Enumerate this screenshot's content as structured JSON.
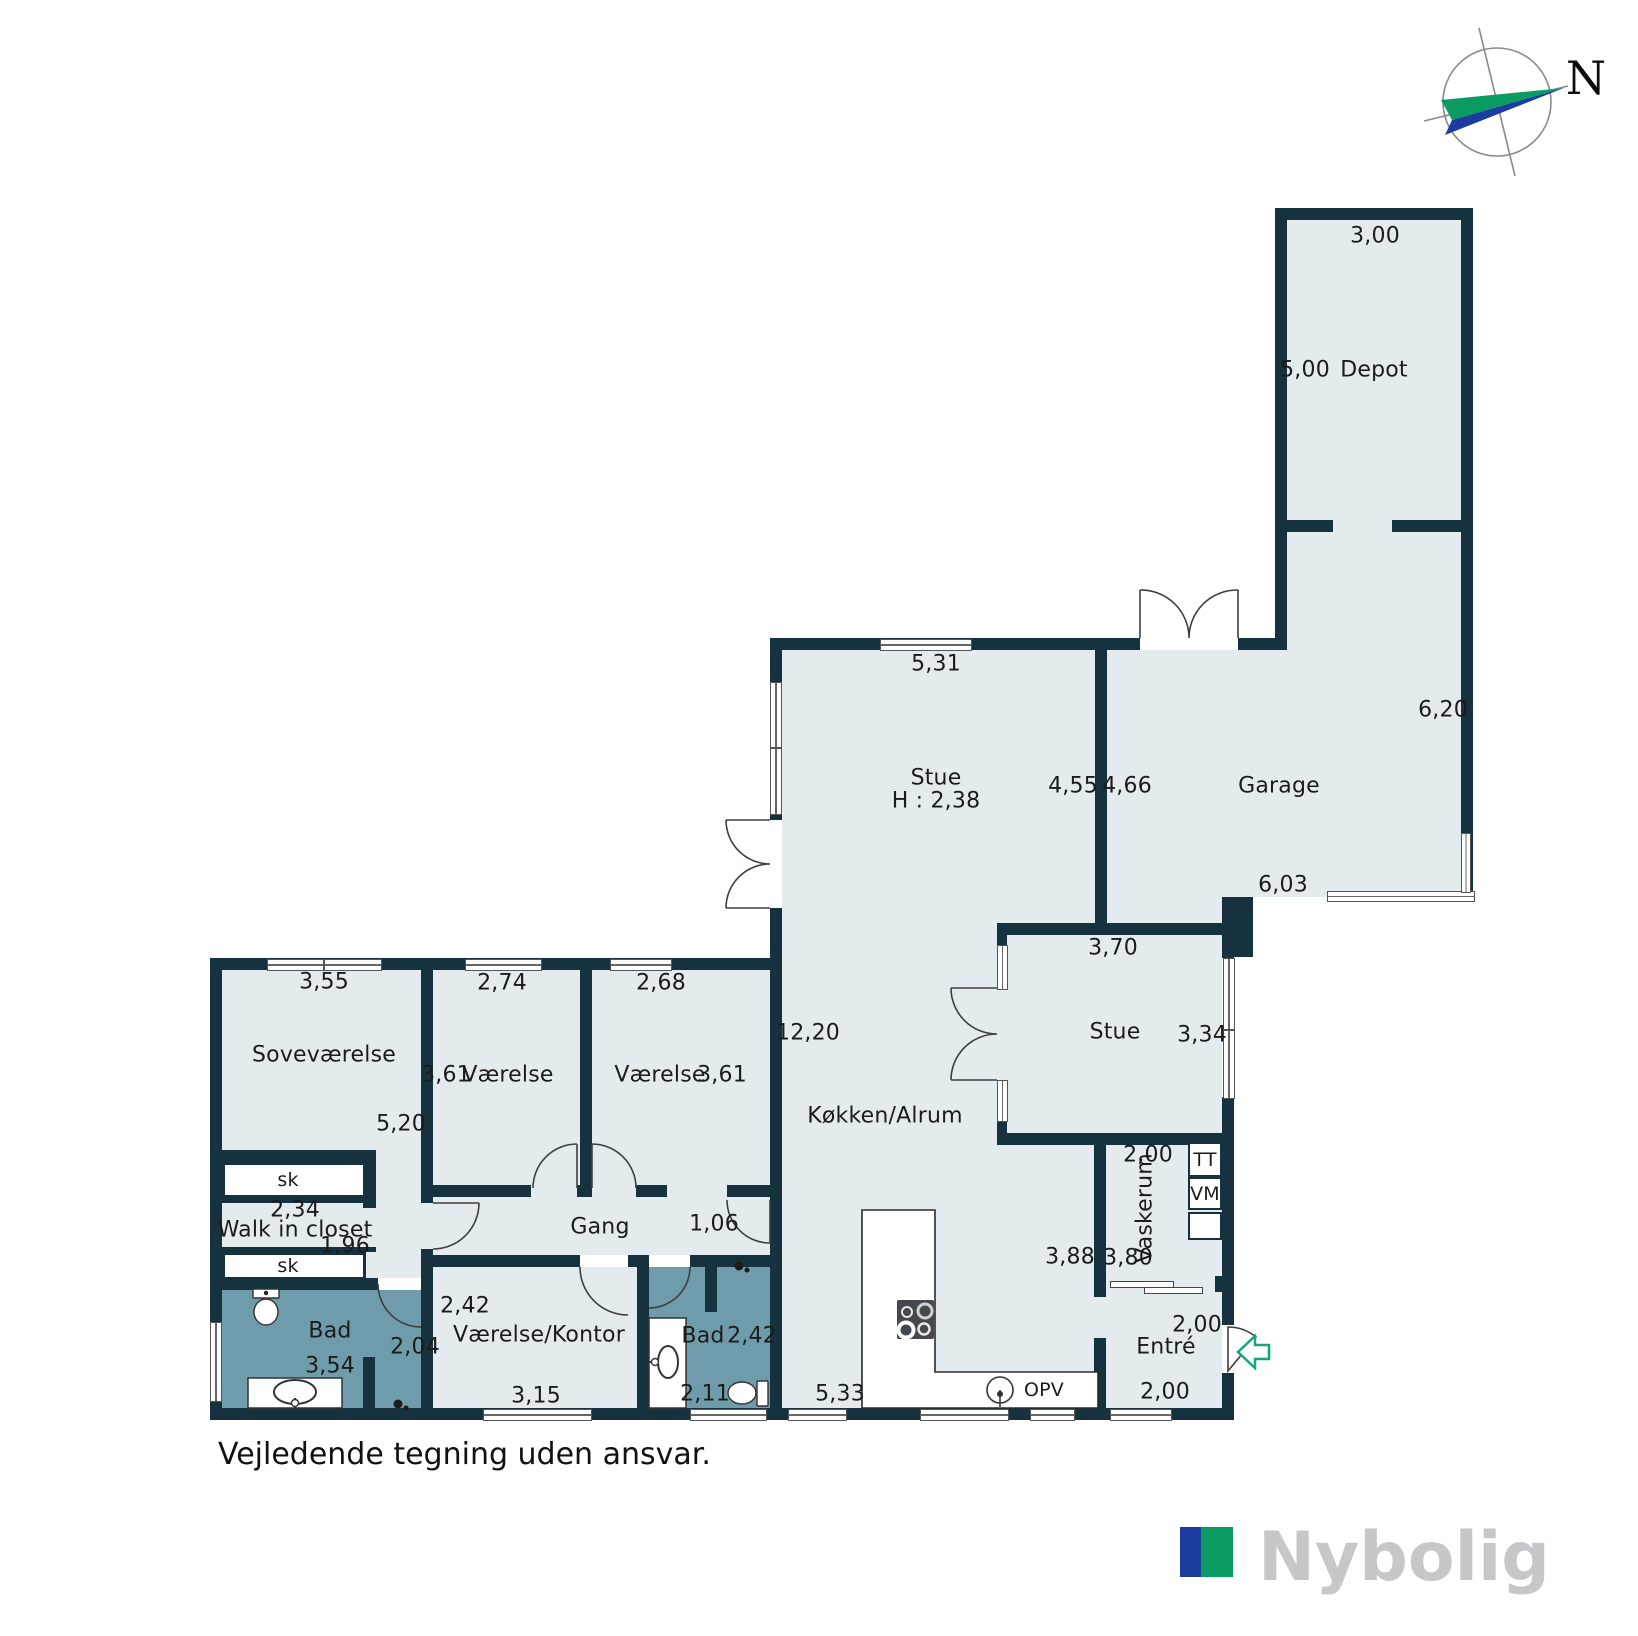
{
  "note": "Vejledende tegning uden ansvar.",
  "compass": {
    "north_label": "N"
  },
  "brand": {
    "name": "Nybolig",
    "blue": "#1c3ca0",
    "green": "#0a9b62",
    "text_gray": "#c5c7c9"
  },
  "colors": {
    "wall": "#16323f",
    "floor": "#e4ebee",
    "bath_floor": "#6f9cab",
    "accent_green": "#16a57c"
  },
  "rooms": {
    "depot": {
      "name": "Depot",
      "width": "3,00",
      "depth": "5,00"
    },
    "garage": {
      "name": "Garage",
      "depth_east": "6,20",
      "depth_west": "4,66",
      "width": "6,03"
    },
    "stue1": {
      "name": "Stue",
      "ceiling_height": "H : 2,38",
      "width": "5,31",
      "depth": "4,55"
    },
    "koekken": {
      "name": "Køkken/Alrum",
      "length": "12,20",
      "width": "5,33",
      "dim_east": "3,88",
      "dishwasher": "OPV"
    },
    "stue2": {
      "name": "Stue",
      "width": "3,70",
      "depth": "3,34"
    },
    "sovevaerelse": {
      "name": "Soveværelse",
      "width": "3,55",
      "depth": "5,20"
    },
    "vaerelse1": {
      "name": "Værelse",
      "width": "2,74",
      "depth": "3,61"
    },
    "vaerelse2": {
      "name": "Værelse",
      "width": "2,68",
      "depth": "3,61"
    },
    "walkincloset": {
      "name": "Walk in closet",
      "width": "2,34",
      "depth": "1,96",
      "closet1": "sk",
      "closet2": "sk"
    },
    "bad1": {
      "name": "Bad",
      "width": "3,54",
      "door_dim": "2,04"
    },
    "gang": {
      "name": "Gang",
      "opening": "1,06"
    },
    "vaerelse_kontor": {
      "name": "Værelse/Kontor",
      "width": "3,15",
      "depth": "2,42"
    },
    "bad2": {
      "name": "Bad",
      "depth": "2,42",
      "width": "2,11"
    },
    "vaskerum": {
      "name": "Vaskerum",
      "width": "2,00",
      "depth": "3,80",
      "dryer": "TT",
      "washer": "VM"
    },
    "entre": {
      "name": "Entré",
      "width": "2,00",
      "depth": "2,00"
    }
  }
}
